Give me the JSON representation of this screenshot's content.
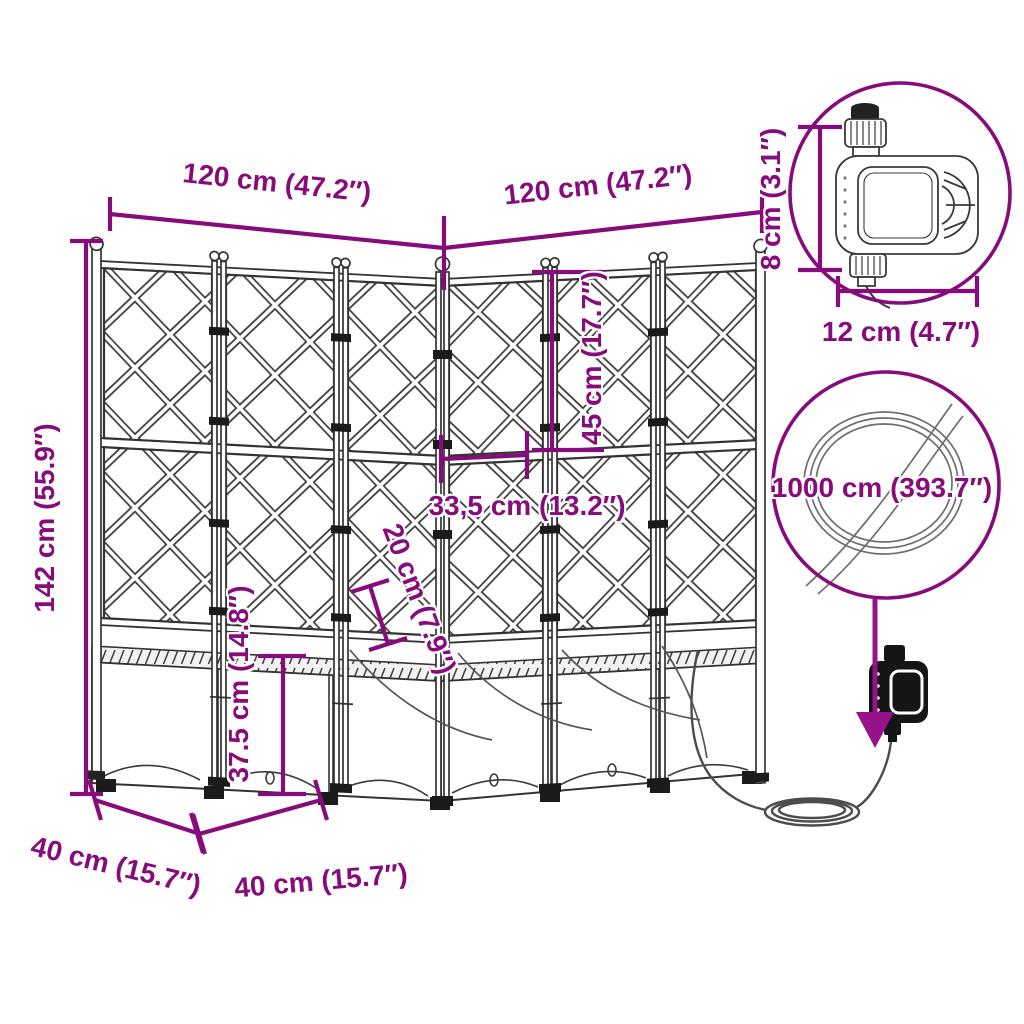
{
  "colors": {
    "accent": "#870C7B",
    "arrow": "#96128B",
    "line_art": "#3A3A3A",
    "background": "#FFFFFF"
  },
  "diagram": {
    "dimensions": {
      "top_left": "120 cm (47.2″)",
      "top_right": "120 cm (47.2″)",
      "height": "142 cm (55.9″)",
      "upper_trellis": "45 cm (17.7″)",
      "corner_width": "33,5 cm (13.2″)",
      "upper_box_depth": "20 cm (7.9″)",
      "box_height": "37.5 cm (14.8″)",
      "base_left": "40 cm (15.7″)",
      "base_right": "40 cm (15.7″)",
      "timer_height": "8 cm (3.1″)",
      "timer_width": "12 cm (4.7″)",
      "hose_length": "1000 cm (393.7″)"
    },
    "callouts": {
      "timer": "water-timer-detail",
      "hose": "hose-coil-detail"
    }
  }
}
